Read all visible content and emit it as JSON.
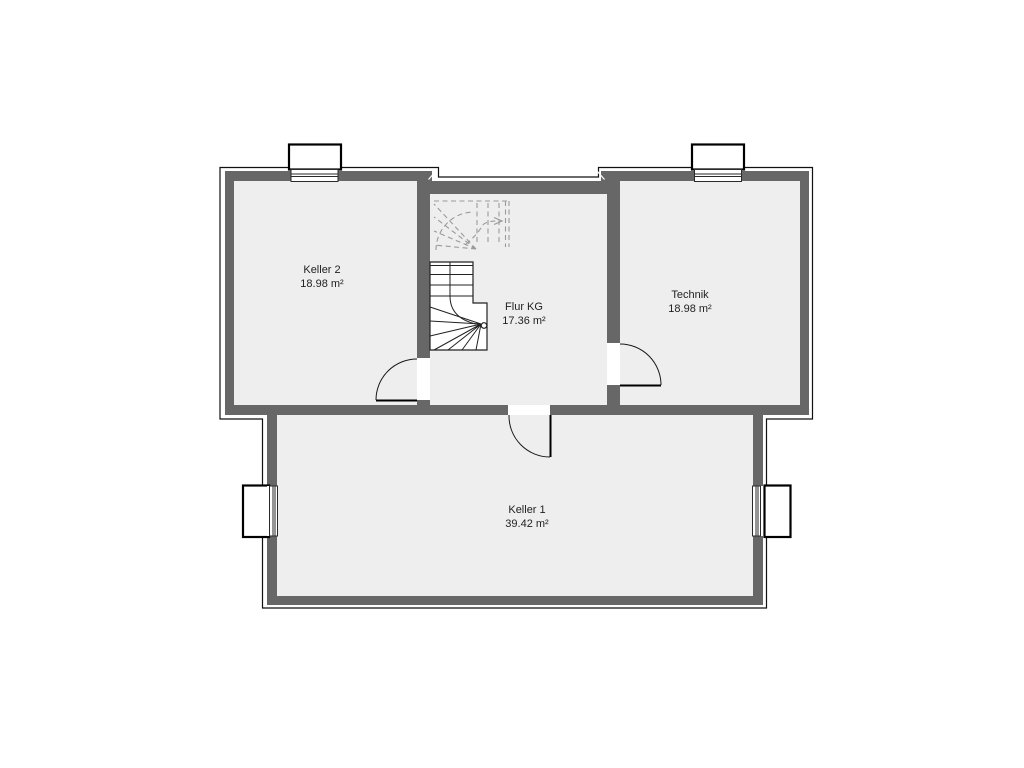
{
  "plan": {
    "level_hint": "KG",
    "rooms": [
      {
        "id": "keller2",
        "name": "Keller 2",
        "area": "18.98 m²"
      },
      {
        "id": "flur_kg",
        "name": "Flur KG",
        "area": "17.36 m²"
      },
      {
        "id": "technik",
        "name": "Technik",
        "area": "18.98 m²"
      },
      {
        "id": "keller1",
        "name": "Keller 1",
        "area": "39.42 m²"
      }
    ]
  },
  "colors": {
    "bg": "#ffffff",
    "wall": "#676767",
    "room": "#eeeeee",
    "line": "#111111",
    "stairdash": "#9a9a9a",
    "label": "#1f1f1f"
  }
}
